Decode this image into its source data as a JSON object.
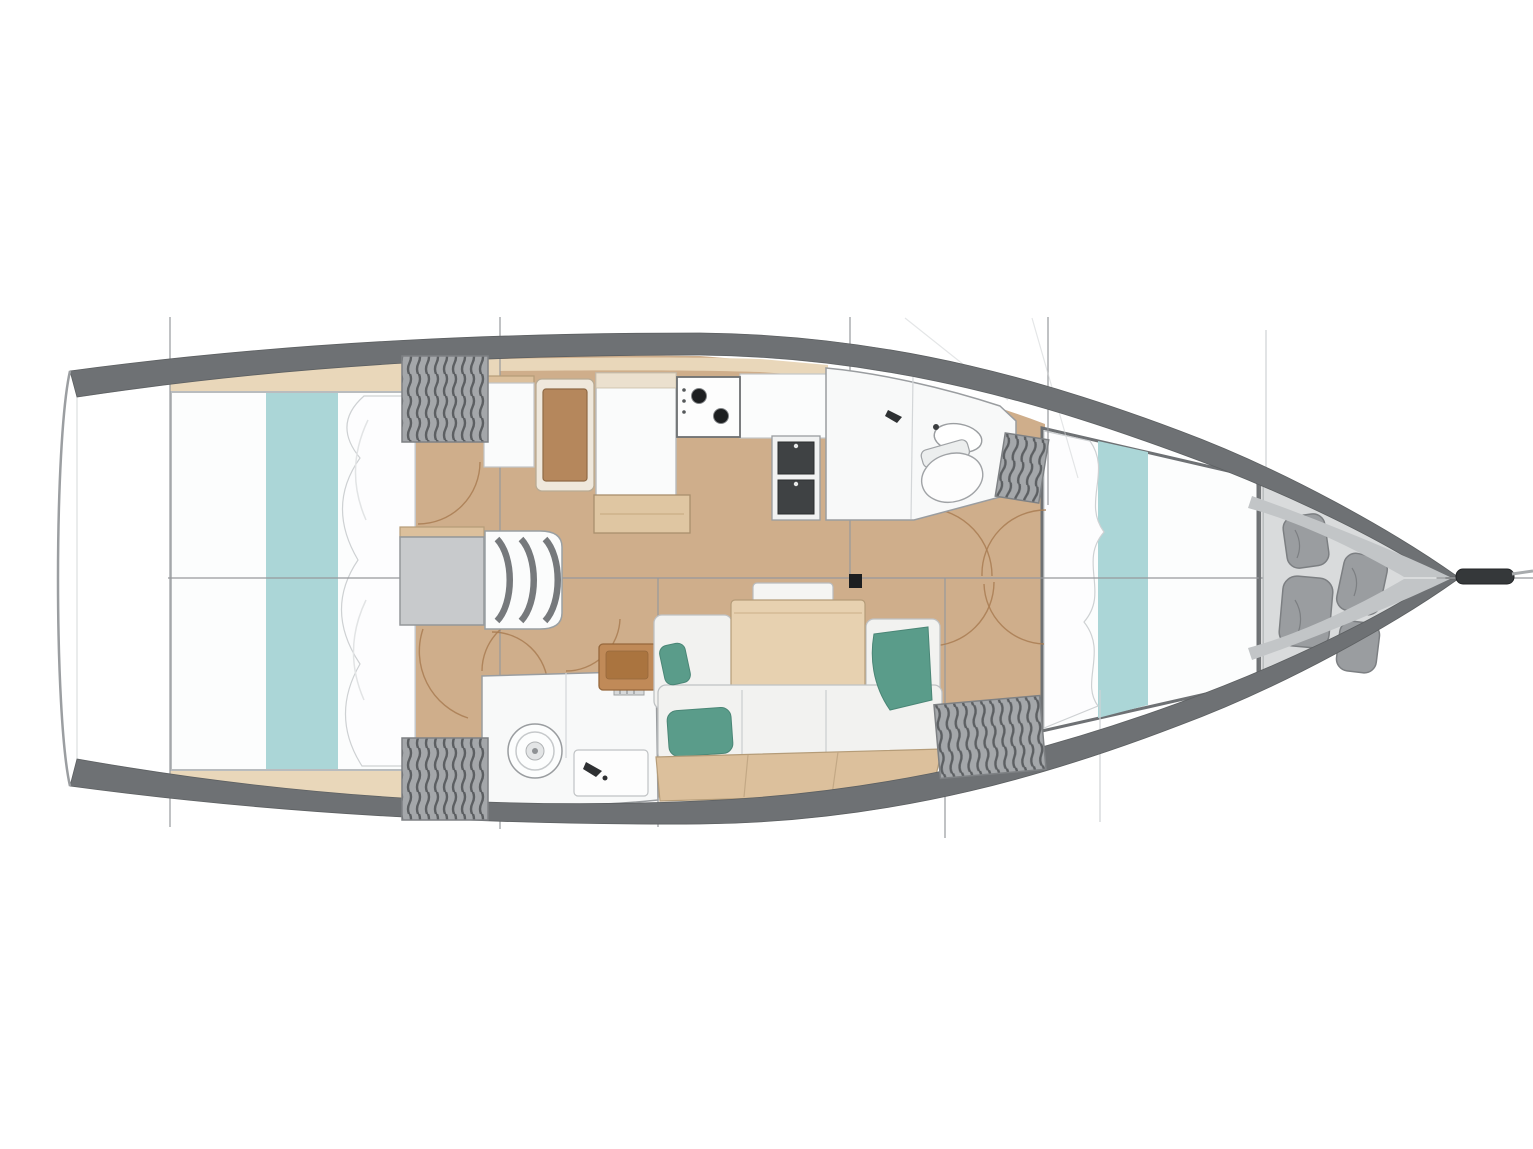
{
  "diagram": {
    "title": "Sailing yacht interior layout plan (top view)",
    "view": "top-down floor plan",
    "orientation": "bow pointing right, stern at left",
    "rooms": [
      {
        "name": "aft-owner-cabin",
        "features": [
          "island-double-bed",
          "teal-bed-runner",
          "pillows",
          "hanging-locker-port",
          "hanging-locker-starboard",
          "door-swing-arcs"
        ]
      },
      {
        "name": "companionway",
        "features": [
          "engine-box",
          "curved-steps-x3"
        ]
      },
      {
        "name": "navigation-area",
        "features": [
          "cabinet",
          "navigator-seat",
          "chart-table",
          "shelf"
        ]
      },
      {
        "name": "galley",
        "features": [
          "two-burner-stove",
          "double-sink",
          "counters",
          "overhead-stowage"
        ]
      },
      {
        "name": "aft-head",
        "features": [
          "marine-toilet",
          "shower-pan",
          "faucet",
          "vent-grille"
        ]
      },
      {
        "name": "salon",
        "features": [
          "dining-table",
          "folding-leaf",
          "settee-cushions",
          "teal-throw-pillows",
          "mast-post",
          "door-swing-arcs"
        ]
      },
      {
        "name": "forward-head",
        "features": [
          "wash-basin",
          "marine-toilet",
          "shower",
          "faucet"
        ]
      },
      {
        "name": "forward-cabin",
        "features": [
          "v-berth-double-bed",
          "teal-bed-runner",
          "pillows",
          "hanging-locker",
          "wardrobe-locker"
        ]
      },
      {
        "name": "forepeak-sail-locker",
        "features": [
          "sail-bag-1",
          "sail-bag-2",
          "sail-bag-3",
          "sail-bag-4"
        ]
      },
      {
        "name": "bow",
        "features": [
          "anchor-sprit",
          "bow-roller-line"
        ]
      }
    ],
    "drawing_marks": {
      "section_lines": "vertical station lines crossing the hull",
      "centerline": "horizontal fore-aft centerline",
      "rigging_lines": "faint diagonal stay lines near foredeck"
    }
  },
  "colors": {
    "hull_band": "#6e7174",
    "hull_band_light": "#c2c5c7",
    "outline": "#9b9ea1",
    "floor_wood": "#cfae8b",
    "floor_wood_light": "#e9d7ba",
    "furniture_wood": "#e7d1b0",
    "furniture_wood_mid": "#dcc09c",
    "furniture_wood_dark": "#b5875c",
    "cushion_white": "#f2f2f0",
    "teal_runner": "#abd6d7",
    "teal_pillow": "#5a9c8a",
    "locker_gray": "#a4a7aa",
    "locker_stripe": "#5c5f62",
    "bag_gray": "#9a9da0",
    "forepeak_floor": "#d9dbdc",
    "stove_black": "#1d1f21",
    "line_gray": "#97999c",
    "line_faint": "#cfd2d4",
    "door_arc": "#a97c52",
    "engine_box": "#c8cacc",
    "mast_black": "#1c1e20",
    "bowsprit_dark": "#35383a"
  }
}
